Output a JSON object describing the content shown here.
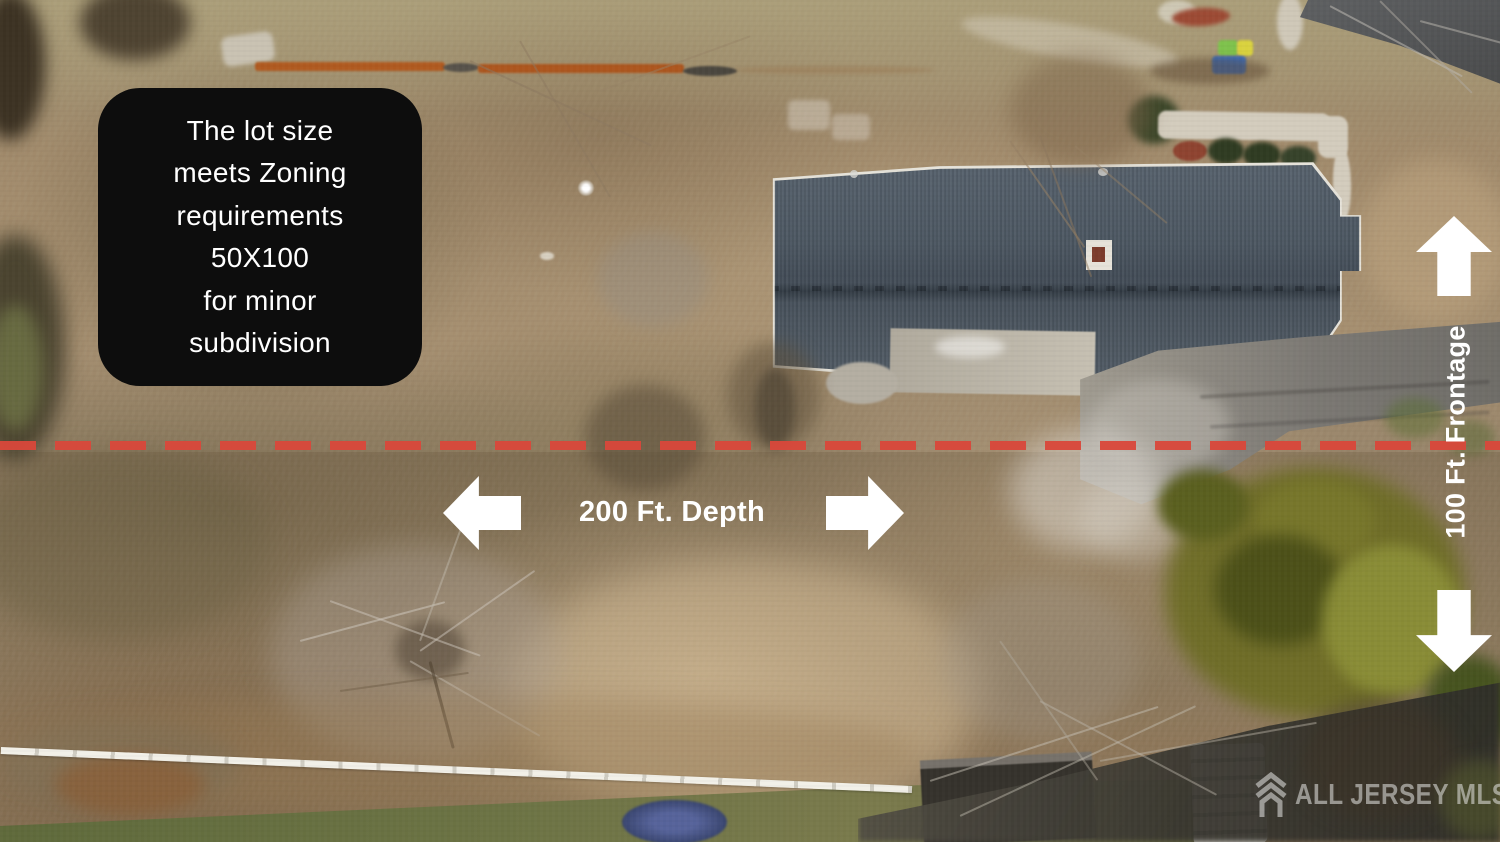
{
  "annotation_box": {
    "lines": [
      "The lot size",
      "meets Zoning",
      "requirements",
      "50X100",
      "for minor",
      "subdivision"
    ]
  },
  "measurements": {
    "depth_label": "200 Ft. Depth",
    "frontage_label": "100 Ft. Frontage"
  },
  "watermark": {
    "text": "ALL JERSEY MLS"
  },
  "icons": {
    "left_arrow": "solid-block-arrow-left",
    "right_arrow": "solid-block-arrow-right",
    "up_arrow": "solid-block-arrow-up",
    "down_arrow": "solid-block-arrow-down",
    "logo": "house-chevron-logo"
  },
  "colors": {
    "boundary_dash": "#d9473a",
    "annotation_bg": "#0d0d0d",
    "annotation_text": "#ffffff",
    "arrow": "#ffffff",
    "watermark_text": "rgba(232,232,230,0.55)"
  }
}
